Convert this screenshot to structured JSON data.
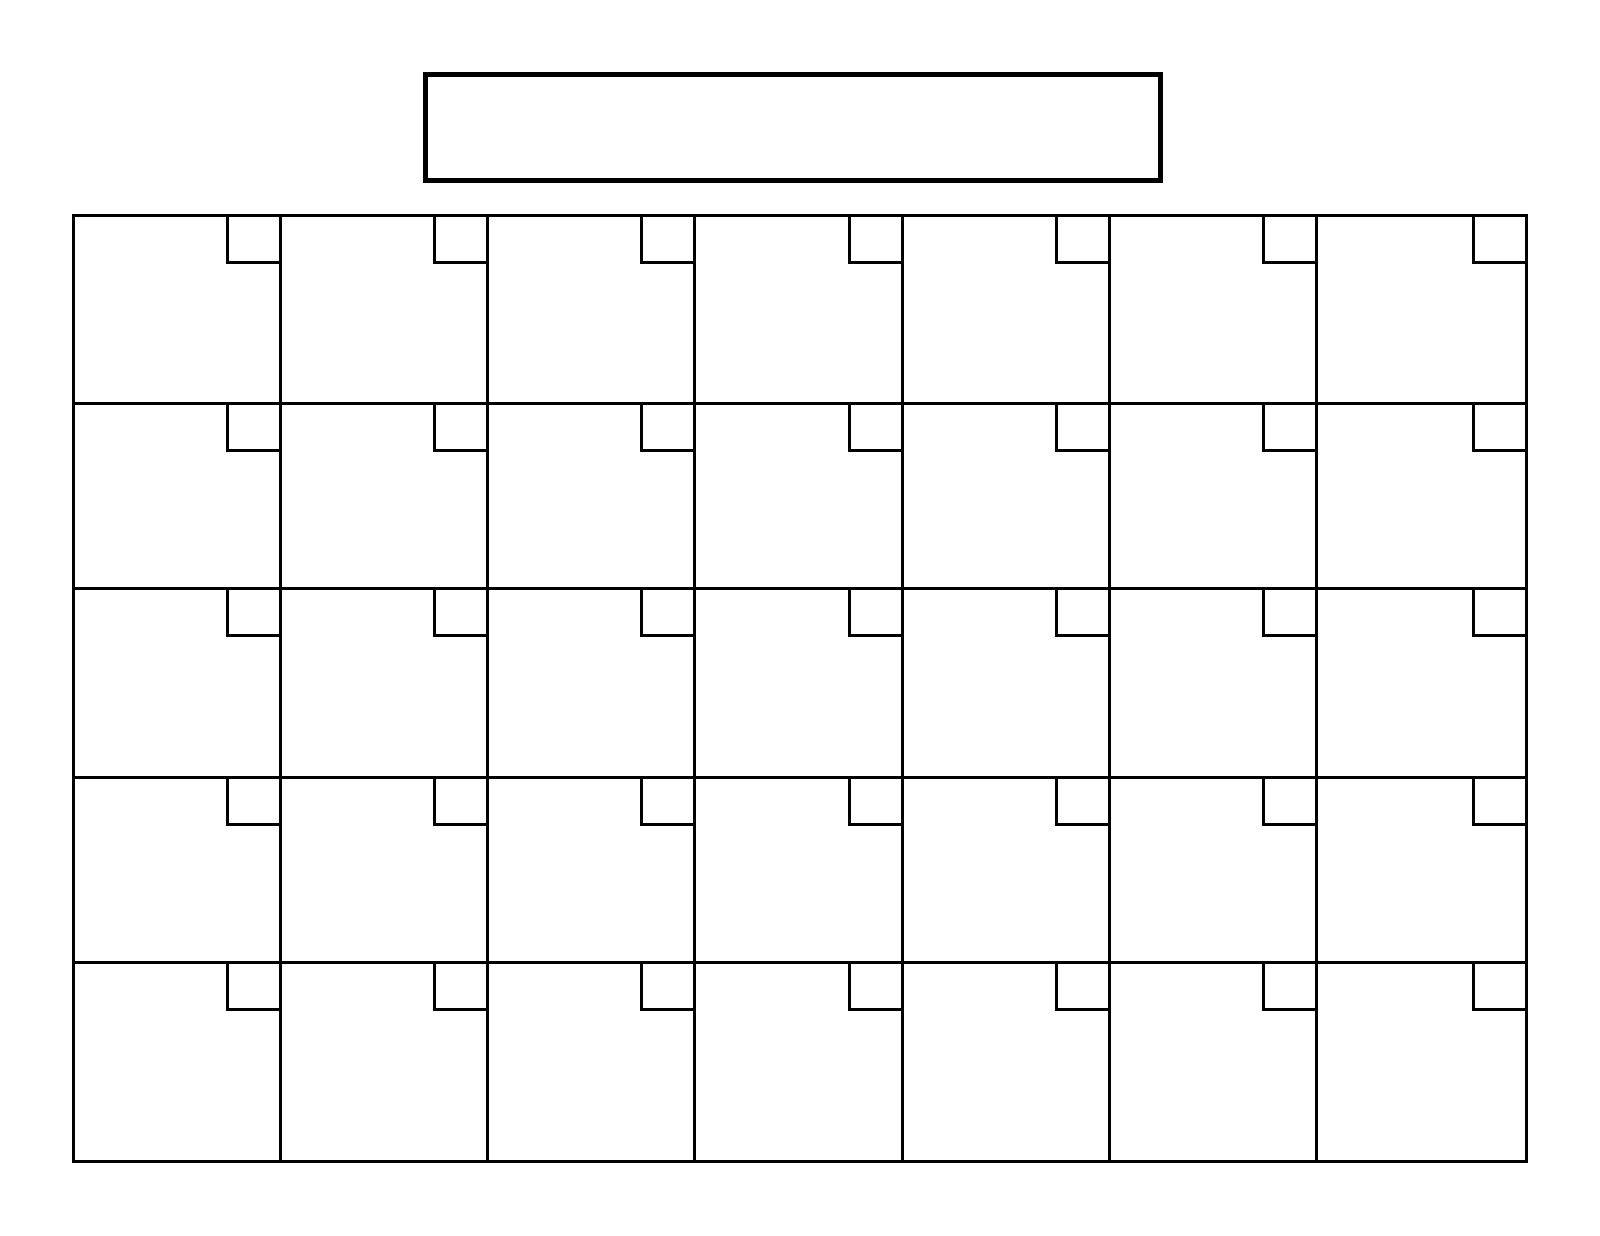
{
  "page": {
    "background_color": "#ffffff",
    "line_color": "#000000"
  },
  "title_box": {
    "value": "",
    "description": "blank-month-year-title-field"
  },
  "calendar": {
    "columns": 7,
    "rows": 5,
    "cell_count": 35,
    "cells": [
      {
        "day": ""
      },
      {
        "day": ""
      },
      {
        "day": ""
      },
      {
        "day": ""
      },
      {
        "day": ""
      },
      {
        "day": ""
      },
      {
        "day": ""
      },
      {
        "day": ""
      },
      {
        "day": ""
      },
      {
        "day": ""
      },
      {
        "day": ""
      },
      {
        "day": ""
      },
      {
        "day": ""
      },
      {
        "day": ""
      },
      {
        "day": ""
      },
      {
        "day": ""
      },
      {
        "day": ""
      },
      {
        "day": ""
      },
      {
        "day": ""
      },
      {
        "day": ""
      },
      {
        "day": ""
      },
      {
        "day": ""
      },
      {
        "day": ""
      },
      {
        "day": ""
      },
      {
        "day": ""
      },
      {
        "day": ""
      },
      {
        "day": ""
      },
      {
        "day": ""
      },
      {
        "day": ""
      },
      {
        "day": ""
      },
      {
        "day": ""
      },
      {
        "day": ""
      },
      {
        "day": ""
      },
      {
        "day": ""
      },
      {
        "day": ""
      }
    ]
  }
}
